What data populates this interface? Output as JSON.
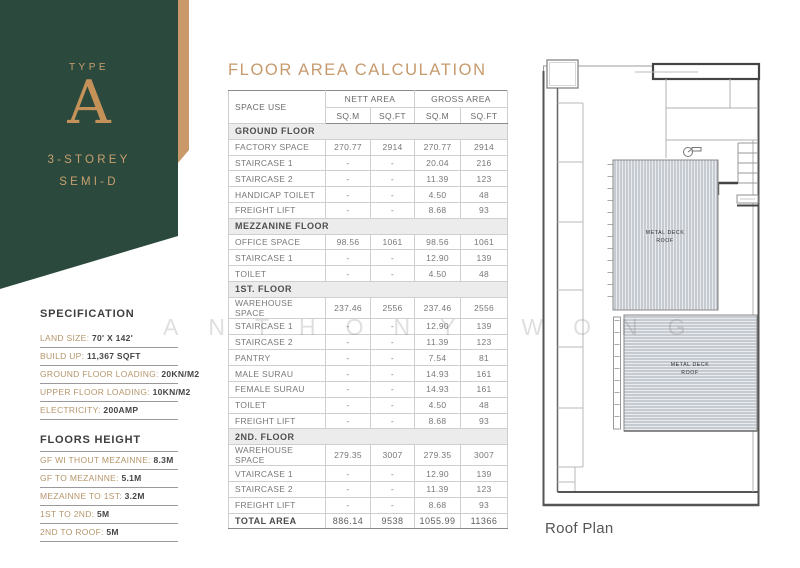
{
  "panel": {
    "type_label": "TYPE",
    "type_letter": "A",
    "storey": "3-STOREY",
    "semi": "SEMI-D"
  },
  "specification": {
    "heading": "SPECIFICATION",
    "items": [
      {
        "label": "LAND SIZE:",
        "value": "70' X 142'"
      },
      {
        "label": "BUILD UP:",
        "value": "11,367 SQFT"
      },
      {
        "label": "GROUND FLOOR LOADING:",
        "value": "20KN/M2"
      },
      {
        "label": "UPPER FLOOR LOADING:",
        "value": "10KN/M2"
      },
      {
        "label": "ELECTRICITY:",
        "value": "200AMP"
      }
    ],
    "floors_heading": "FLOORS HEIGHT",
    "floors_items": [
      {
        "label": "GF WI THOUT MEZAINNE:",
        "value": "8.3M"
      },
      {
        "label": "GF TO MEZAINNE:",
        "value": "5.1M"
      },
      {
        "label": "MEZAINNE TO 1ST:",
        "value": "3.2M"
      },
      {
        "label": "1ST TO 2ND:",
        "value": "5M"
      },
      {
        "label": "2ND TO ROOF:",
        "value": "5M"
      }
    ]
  },
  "table": {
    "title": "FLOOR AREA CALCULATION",
    "headers": {
      "space_use": "SPACE USE",
      "nett_area": "NETT AREA",
      "gross_area": "GROSS AREA",
      "sqm": "SQ.M",
      "sqft": "SQ.FT"
    },
    "rows": [
      {
        "type": "section",
        "label": "GROUND FLOOR"
      },
      {
        "type": "data",
        "label": "FACTORY SPACE",
        "nett_sqm": "270.77",
        "nett_sqft": "2914",
        "gross_sqm": "270.77",
        "gross_sqft": "2914"
      },
      {
        "type": "data",
        "label": "STAIRCASE 1",
        "nett_sqm": "-",
        "nett_sqft": "-",
        "gross_sqm": "20.04",
        "gross_sqft": "216"
      },
      {
        "type": "data",
        "label": "STAIRCASE 2",
        "nett_sqm": "-",
        "nett_sqft": "-",
        "gross_sqm": "11.39",
        "gross_sqft": "123"
      },
      {
        "type": "data",
        "label": "HANDICAP TOILET",
        "nett_sqm": "-",
        "nett_sqft": "-",
        "gross_sqm": "4.50",
        "gross_sqft": "48"
      },
      {
        "type": "data",
        "label": "FREIGHT LIFT",
        "nett_sqm": "-",
        "nett_sqft": "-",
        "gross_sqm": "8.68",
        "gross_sqft": "93"
      },
      {
        "type": "section",
        "label": "MEZZANINE FLOOR"
      },
      {
        "type": "data",
        "label": "OFFICE SPACE",
        "nett_sqm": "98.56",
        "nett_sqft": "1061",
        "gross_sqm": "98.56",
        "gross_sqft": "1061"
      },
      {
        "type": "data",
        "label": "STAIRCASE 1",
        "nett_sqm": "-",
        "nett_sqft": "-",
        "gross_sqm": "12.90",
        "gross_sqft": "139"
      },
      {
        "type": "data",
        "label": "TOILET",
        "nett_sqm": "-",
        "nett_sqft": "-",
        "gross_sqm": "4.50",
        "gross_sqft": "48"
      },
      {
        "type": "section",
        "label": "1ST. FLOOR"
      },
      {
        "type": "data",
        "label": "WAREHOUSE SPACE",
        "nett_sqm": "237.46",
        "nett_sqft": "2556",
        "gross_sqm": "237.46",
        "gross_sqft": "2556"
      },
      {
        "type": "data",
        "label": "STAIRCASE 1",
        "nett_sqm": "-",
        "nett_sqft": "-",
        "gross_sqm": "12.90",
        "gross_sqft": "139"
      },
      {
        "type": "data",
        "label": "STAIRCASE 2",
        "nett_sqm": "-",
        "nett_sqft": "-",
        "gross_sqm": "11.39",
        "gross_sqft": "123"
      },
      {
        "type": "data",
        "label": "PANTRY",
        "nett_sqm": "-",
        "nett_sqft": "-",
        "gross_sqm": "7.54",
        "gross_sqft": "81"
      },
      {
        "type": "data",
        "label": "MALE SURAU",
        "nett_sqm": "-",
        "nett_sqft": "-",
        "gross_sqm": "14.93",
        "gross_sqft": "161"
      },
      {
        "type": "data",
        "label": "FEMALE SURAU",
        "nett_sqm": "-",
        "nett_sqft": "-",
        "gross_sqm": "14.93",
        "gross_sqft": "161"
      },
      {
        "type": "data",
        "label": "TOILET",
        "nett_sqm": "-",
        "nett_sqft": "-",
        "gross_sqm": "4.50",
        "gross_sqft": "48"
      },
      {
        "type": "data",
        "label": "FREIGHT LIFT",
        "nett_sqm": "-",
        "nett_sqft": "-",
        "gross_sqm": "8.68",
        "gross_sqft": "93"
      },
      {
        "type": "section",
        "label": "2ND. FLOOR"
      },
      {
        "type": "data",
        "label": "WAREHOUSE SPACE",
        "nett_sqm": "279.35",
        "nett_sqft": "3007",
        "gross_sqm": "279.35",
        "gross_sqft": "3007"
      },
      {
        "type": "data",
        "label": "VTAIRCASE 1",
        "nett_sqm": "-",
        "nett_sqft": "-",
        "gross_sqm": "12.90",
        "gross_sqft": "139"
      },
      {
        "type": "data",
        "label": "STAIRCASE 2",
        "nett_sqm": "-",
        "nett_sqft": "-",
        "gross_sqm": "11.39",
        "gross_sqft": "123"
      },
      {
        "type": "data",
        "label": "FREIGHT LIFT",
        "nett_sqm": "-",
        "nett_sqft": "-",
        "gross_sqm": "8.68",
        "gross_sqft": "93"
      },
      {
        "type": "total",
        "label": "TOTAL AREA",
        "nett_sqm": "886.14",
        "nett_sqft": "9538",
        "gross_sqm": "1055.99",
        "gross_sqft": "11366"
      }
    ]
  },
  "roof_plan": {
    "caption": "Roof Plan",
    "deck_line1": "METAL DECK",
    "deck_line2": "ROOF"
  },
  "watermark": "ANTHONY WONG",
  "colors": {
    "panel_green": "#2b4a3d",
    "accent_gold": "#c9996a",
    "title_tan": "#c79a6e",
    "section_row_bg": "#ececec"
  }
}
